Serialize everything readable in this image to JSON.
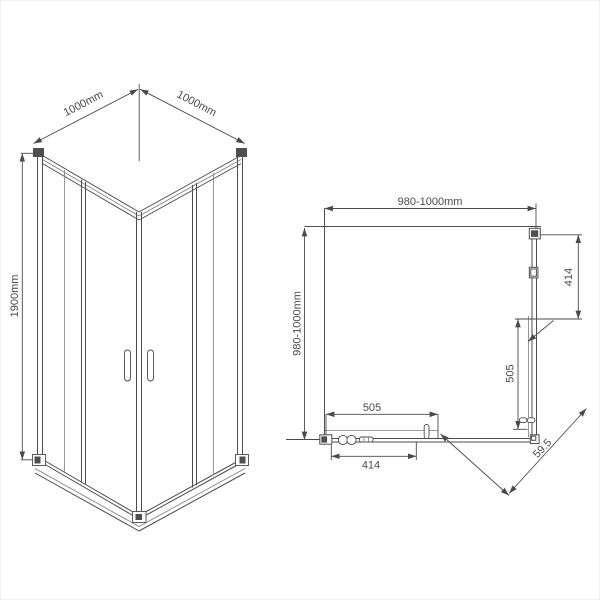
{
  "drawing_title": "corner shower enclosure technical drawing",
  "colors": {
    "line": "#4d4d4d",
    "dimension": "#4a4a4a",
    "background": "#ffffff"
  },
  "iso_view": {
    "dim_width_left": "1000mm",
    "dim_width_right": "1000mm",
    "dim_height": "1900mm"
  },
  "plan_view": {
    "dim_width_top": "980-1000mm",
    "dim_depth_left": "980-1000mm",
    "dim_side_fixed_panel": "414",
    "dim_side_door": "505",
    "dim_front_door": "505",
    "dim_front_glass": "414",
    "dim_diagonal_entry": "59.5"
  }
}
